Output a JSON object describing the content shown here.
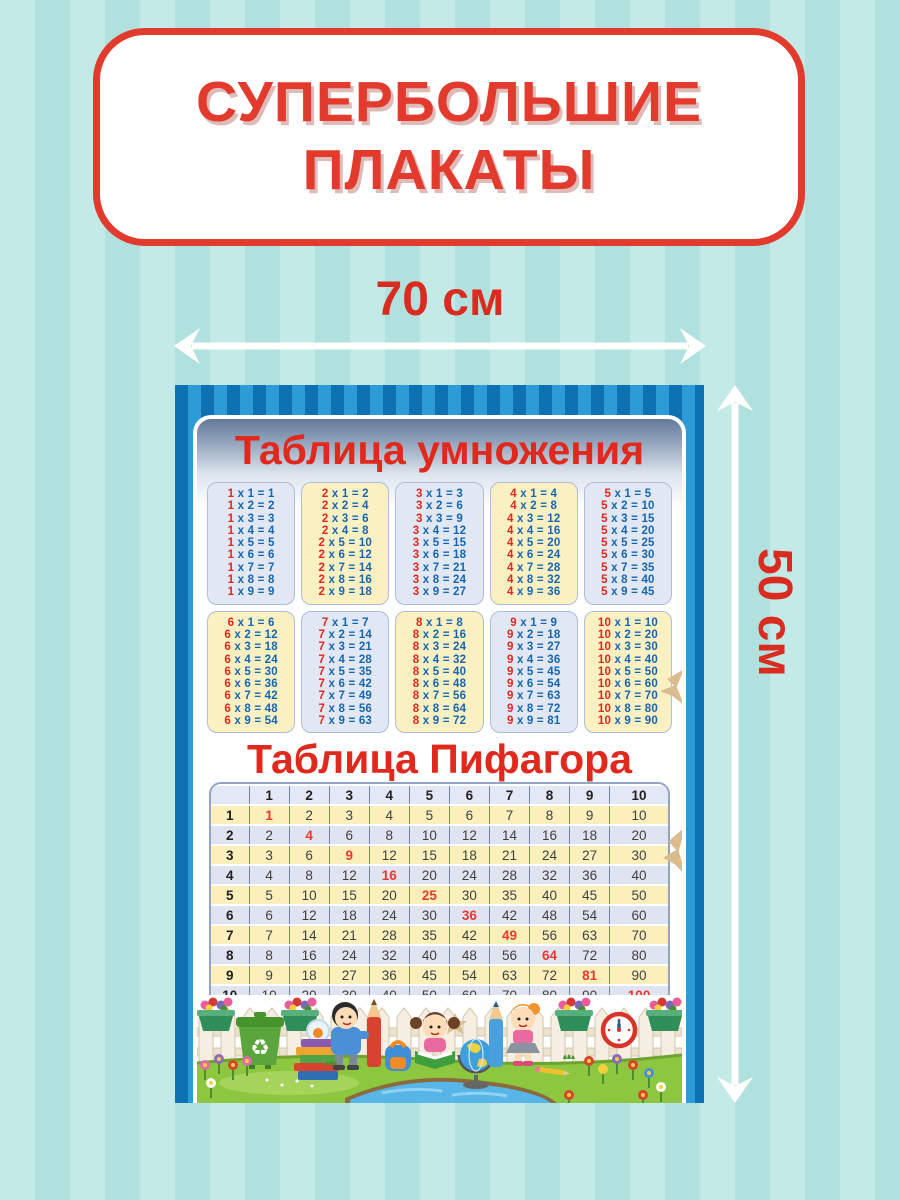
{
  "banner": {
    "line1": "СУПЕРБОЛЬШИЕ",
    "line2": "ПЛАКАТЫ"
  },
  "size_labels": {
    "width": "70 см",
    "height": "50 см"
  },
  "poster": {
    "multiplication_title": "Таблица умножения",
    "pythagoras_title": "Таблица Пифагора",
    "mult_cards": [
      {
        "tone": "lavender",
        "rows": [
          "1 x 1 = 1",
          "1 x 2 = 2",
          "1 x 3 = 3",
          "1 x 4 = 4",
          "1 x 5 = 5",
          "1 x 6 = 6",
          "1 x 7 = 7",
          "1 x 8 = 8",
          "1 x 9 = 9"
        ]
      },
      {
        "tone": "yellow",
        "rows": [
          "2 x 1 = 2",
          "2 x 2 = 4",
          "2 x 3 = 6",
          "2 x 4 = 8",
          "2 x 5 = 10",
          "2 x 6 = 12",
          "2 x 7 = 14",
          "2 x 8 = 16",
          "2 x 9 = 18"
        ]
      },
      {
        "tone": "lavender",
        "rows": [
          "3 x 1 = 3",
          "3 x 2 = 6",
          "3 x 3 = 9",
          "3 x 4 = 12",
          "3 x 5 = 15",
          "3 x 6 = 18",
          "3 x 7 = 21",
          "3 x 8 = 24",
          "3 x 9 = 27"
        ]
      },
      {
        "tone": "yellow",
        "rows": [
          "4 x 1 = 4",
          "4 x 2 = 8",
          "4 x 3 = 12",
          "4 x 4 = 16",
          "4 x 5 = 20",
          "4 x 6 = 24",
          "4 x 7 = 28",
          "4 x 8 = 32",
          "4 x 9 = 36"
        ]
      },
      {
        "tone": "lavender",
        "rows": [
          "5 x 1 = 5",
          "5 x 2 = 10",
          "5 x 3 = 15",
          "5 x 4 = 20",
          "5 x 5 = 25",
          "5 x 6 = 30",
          "5 x 7 = 35",
          "5 x 8 = 40",
          "5 x 9 = 45"
        ]
      },
      {
        "tone": "yellow",
        "rows": [
          "6 x 1 = 6",
          "6 x 2 = 12",
          "6 x 3 = 18",
          "6 x 4 = 24",
          "6 x 5 = 30",
          "6 x 6 = 36",
          "6 x 7 = 42",
          "6 x 8 = 48",
          "6 x 9 = 54"
        ]
      },
      {
        "tone": "lavender",
        "rows": [
          "7 x 1 = 7",
          "7 x 2 = 14",
          "7 x 3 = 21",
          "7 x 4 = 28",
          "7 x 5 = 35",
          "7 x 6 = 42",
          "7 x 7 = 49",
          "7 x 8 = 56",
          "7 x 9 = 63"
        ]
      },
      {
        "tone": "yellow",
        "rows": [
          "8 x 1 = 8",
          "8 x 2 = 16",
          "8 x 3 = 24",
          "8 x 4 = 32",
          "8 x 5 = 40",
          "8 x 6 = 48",
          "8 x 7 = 56",
          "8 x 8 = 64",
          "8 x 9 = 72"
        ]
      },
      {
        "tone": "lavender",
        "rows": [
          "9 x 1 = 9",
          "9 x 2 = 18",
          "9 x 3 = 27",
          "9 x 4 = 36",
          "9 x 5 = 45",
          "9 x 6 = 54",
          "9 x 7 = 63",
          "9 x 8 = 72",
          "9 x 9 = 81"
        ]
      },
      {
        "tone": "yellow",
        "rows": [
          "10 x 1 = 10",
          "10 x 2 = 20",
          "10 x 3 = 30",
          "10 x 4 = 40",
          "10 x 5 = 50",
          "10 x 6 = 60",
          "10 x 7 = 70",
          "10 x 8 = 80",
          "10 x 9 = 90"
        ]
      }
    ],
    "pythagoras": {
      "corner": "",
      "col_headers": [
        "1",
        "2",
        "3",
        "4",
        "5",
        "6",
        "7",
        "8",
        "9",
        "10"
      ],
      "rows": [
        {
          "label": "1",
          "values": [
            "1",
            "2",
            "3",
            "4",
            "5",
            "6",
            "7",
            "8",
            "9",
            "10"
          ]
        },
        {
          "label": "2",
          "values": [
            "2",
            "4",
            "6",
            "8",
            "10",
            "12",
            "14",
            "16",
            "18",
            "20"
          ]
        },
        {
          "label": "3",
          "values": [
            "3",
            "6",
            "9",
            "12",
            "15",
            "18",
            "21",
            "24",
            "27",
            "30"
          ]
        },
        {
          "label": "4",
          "values": [
            "4",
            "8",
            "12",
            "16",
            "20",
            "24",
            "28",
            "32",
            "36",
            "40"
          ]
        },
        {
          "label": "5",
          "values": [
            "5",
            "10",
            "15",
            "20",
            "25",
            "30",
            "35",
            "40",
            "45",
            "50"
          ]
        },
        {
          "label": "6",
          "values": [
            "6",
            "12",
            "18",
            "24",
            "30",
            "36",
            "42",
            "48",
            "54",
            "60"
          ]
        },
        {
          "label": "7",
          "values": [
            "7",
            "14",
            "21",
            "28",
            "35",
            "42",
            "49",
            "56",
            "63",
            "70"
          ]
        },
        {
          "label": "8",
          "values": [
            "8",
            "16",
            "24",
            "32",
            "40",
            "48",
            "56",
            "64",
            "72",
            "80"
          ]
        },
        {
          "label": "9",
          "values": [
            "9",
            "18",
            "27",
            "36",
            "45",
            "54",
            "63",
            "72",
            "81",
            "90"
          ]
        },
        {
          "label": "10",
          "values": [
            "10",
            "20",
            "30",
            "40",
            "50",
            "60",
            "70",
            "80",
            "90",
            "100"
          ]
        }
      ]
    },
    "illustration_items": [
      "picket-fence",
      "flower-boxes",
      "recycle-bin",
      "book-stack-with-fishbowl",
      "boy-hugging-red-pencil",
      "backpack",
      "girl-reading-book",
      "globe",
      "girl-with-blue-pencil",
      "wall-clock",
      "pond",
      "flowers"
    ]
  },
  "colors": {
    "background_stripe_light": "#c3eae7",
    "background_stripe_dark": "#b1e1de",
    "banner_red": "#e23a2c",
    "frame_blue_dark": "#0e71b2",
    "frame_blue_light": "#2d9cd6",
    "card_lavender": "#e1e7f3",
    "card_yellow": "#fbf0c2",
    "equation_red": "#e0261d",
    "equation_blue": "#1566b0",
    "table_row_yellow": "#fbf0bc",
    "table_row_lavender": "#dfe4f0",
    "table_header_bg": "#e3e8f4",
    "diagonal_red": "#e8392c"
  }
}
